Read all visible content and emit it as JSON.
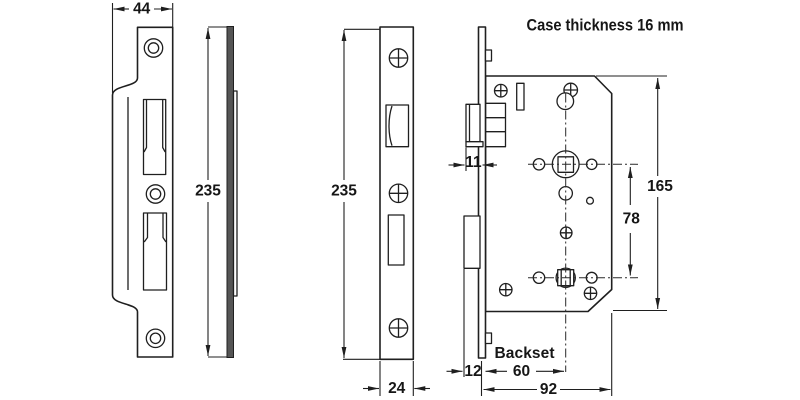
{
  "drawing": {
    "note_case_thickness": "Case thickness 16 mm",
    "label_backset": "Backset",
    "dims": {
      "strike_width_mm": "44",
      "strike_height_mm": "235",
      "forend_height_mm": "235",
      "forend_width_mm": "24",
      "latch_projection_mm": "11",
      "deadbolt_projection_mm": "12",
      "backset_mm": "60",
      "case_depth_mm": "92",
      "follower_centres_mm": "78",
      "case_height_mm": "165"
    },
    "colors": {
      "line": "#1f1f1f",
      "metal_fill": "#555555",
      "background": "#ffffff"
    }
  }
}
